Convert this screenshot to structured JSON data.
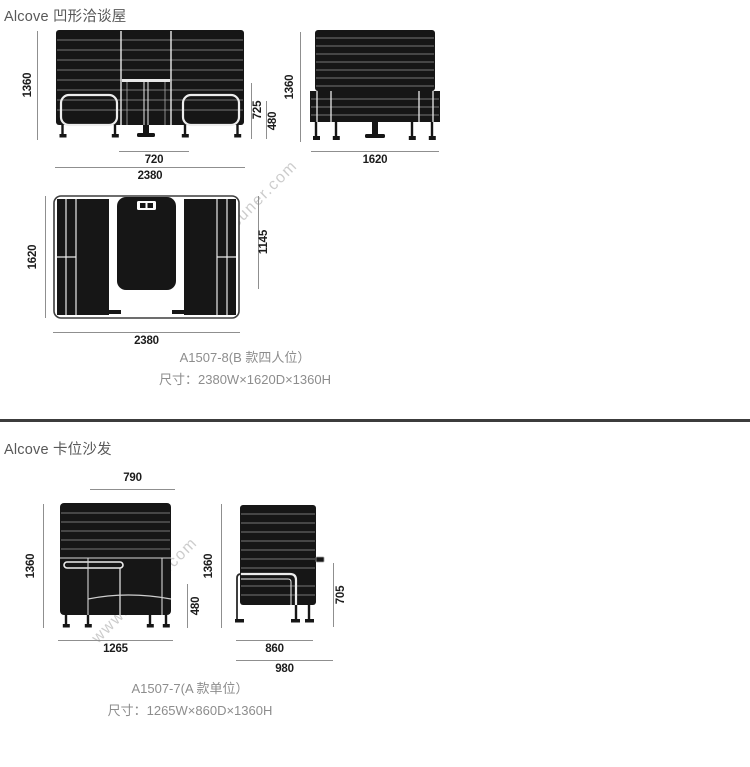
{
  "page": {
    "watermark": "www.nsuner.com"
  },
  "colors": {
    "dimension_line": "#8f8f8f",
    "dimension_text": "#1c1c1c",
    "drawing_fill": "#161616",
    "divider": "#3c3c3c",
    "caption_text": "#8d8d8d"
  },
  "sections": [
    {
      "title": "Alcove 凹形洽谈屋",
      "caption": {
        "model": "A1507-8(B 款四人位）",
        "size": "尺寸：2380W×1620D×1360H"
      },
      "views": {
        "front": {
          "height": "1360",
          "table_height": "725",
          "seat_height": "480",
          "table_width": "720",
          "width": "2380"
        },
        "side": {
          "height": "1360",
          "depth": "1620"
        },
        "top": {
          "depth": "1620",
          "inner_depth": "1145",
          "width": "2380"
        }
      }
    },
    {
      "title": "Alcove 卡位沙发",
      "caption": {
        "model": "A1507-7(A 款单位）",
        "size": "尺寸：1265W×860D×1360H"
      },
      "views": {
        "front": {
          "back_width": "790",
          "height": "1360",
          "width": "1265",
          "seat_height": "480"
        },
        "side": {
          "height": "1360",
          "arm_height": "705",
          "depth": "860",
          "overall_depth": "980"
        }
      }
    }
  ]
}
